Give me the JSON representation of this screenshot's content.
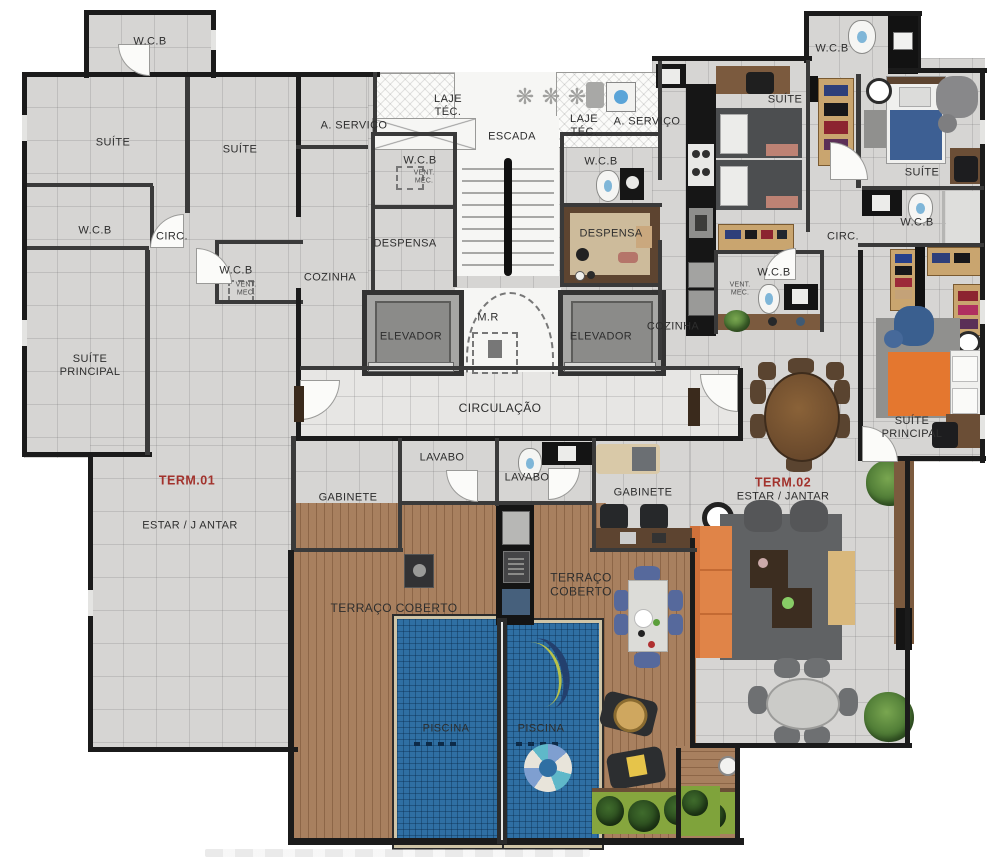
{
  "plan": {
    "type": "residential-floor-plan",
    "units": [
      {
        "id": "TERM.01",
        "living": "ESTAR / J ANTAR",
        "furnished": false
      },
      {
        "id": "TERM.02",
        "living": "ESTAR / JANTAR",
        "furnished": true
      }
    ]
  },
  "labels": [
    {
      "id": "wcb-topleft",
      "text": "W.C.B"
    },
    {
      "id": "suite-left-1",
      "text": "SUÍTE"
    },
    {
      "id": "suite-left-2",
      "text": "SUÍTE"
    },
    {
      "id": "servico-left",
      "text": "A. SERVIÇO"
    },
    {
      "id": "laje-left",
      "text": "LAJE\nTÉC."
    },
    {
      "id": "escada",
      "text": "ESCADA"
    },
    {
      "id": "laje-right",
      "text": "LAJE\nTÉC."
    },
    {
      "id": "servico-right",
      "text": "A. SERVIÇO"
    },
    {
      "id": "suite-right-twin",
      "text": "SUÍTE"
    },
    {
      "id": "wcb-topright",
      "text": "W.C.B"
    },
    {
      "id": "wcb-left-1",
      "text": "W.C.B"
    },
    {
      "id": "circ-left",
      "text": "CIRC."
    },
    {
      "id": "wcb-left-2",
      "text": "W.C.B"
    },
    {
      "id": "ventmec-left",
      "text": "VENT.\nMEC."
    },
    {
      "id": "wcb-core-left",
      "text": "W.C.B"
    },
    {
      "id": "ventmec-core",
      "text": "VENT.\nMEC."
    },
    {
      "id": "wcb-core-right",
      "text": "W.C.B"
    },
    {
      "id": "despensa-left",
      "text": "DESPENSA"
    },
    {
      "id": "despensa-right",
      "text": "DESPENSA"
    },
    {
      "id": "cozinha-left",
      "text": "COZINHA"
    },
    {
      "id": "cozinha-right",
      "text": "COZINHA"
    },
    {
      "id": "elevador-left",
      "text": "ELEVADOR"
    },
    {
      "id": "mr",
      "text": "M.R"
    },
    {
      "id": "elevador-right",
      "text": "ELEVADOR"
    },
    {
      "id": "wcb-right-vent",
      "text": "W.C.B"
    },
    {
      "id": "ventmec-right",
      "text": "VENT.\nMEC."
    },
    {
      "id": "circ-right",
      "text": "CIRC."
    },
    {
      "id": "suite-right",
      "text": "SUÍTE"
    },
    {
      "id": "wcb-right-2",
      "text": "W.C.B"
    },
    {
      "id": "suite-principal-left",
      "text": "SUÍTE\nPRINCIPAL"
    },
    {
      "id": "suite-principal-right",
      "text": "SUÍTE\nPRINCIPAL"
    },
    {
      "id": "term-1",
      "text": "TERM.01"
    },
    {
      "id": "estar-left",
      "text": "ESTAR / J ANTAR"
    },
    {
      "id": "term-2",
      "text": "TERM.02"
    },
    {
      "id": "estar-right",
      "text": "ESTAR / JANTAR"
    },
    {
      "id": "gabinete-left",
      "text": "GABINETE"
    },
    {
      "id": "lavabo-left",
      "text": "LAVABO"
    },
    {
      "id": "lavabo-right",
      "text": "LAVABO"
    },
    {
      "id": "gabinete-right",
      "text": "GABINETE"
    },
    {
      "id": "circulacao",
      "text": "CIRCULAÇÃO"
    },
    {
      "id": "terraco-left",
      "text": "TERRAÇO COBERTO"
    },
    {
      "id": "terraco-right",
      "text": "TERRAÇO\nCOBERTO"
    },
    {
      "id": "piscina-left",
      "text": "PISCINA"
    },
    {
      "id": "piscina-right",
      "text": "PISCINA"
    }
  ],
  "icons": {
    "fan": "❋"
  },
  "colors": {
    "wall": "#1b1b1b",
    "tile": "#d6d5d3",
    "tile_light": "#e7e6e4",
    "deck_wood": "#a8805f",
    "pool_water": "#2f6fa3",
    "accent_red": "#a2322c",
    "sofa_orange": "#e08448",
    "bed_orange": "#e4772f",
    "bed_blue": "#3d5f93",
    "rug_gray": "#606264",
    "plant_green": "#4e7d3a",
    "grass_green": "#86a63e",
    "wood_dark": "#6b4e36",
    "wardrobe_wood": "#c9a56f",
    "counter_black": "#161616"
  }
}
